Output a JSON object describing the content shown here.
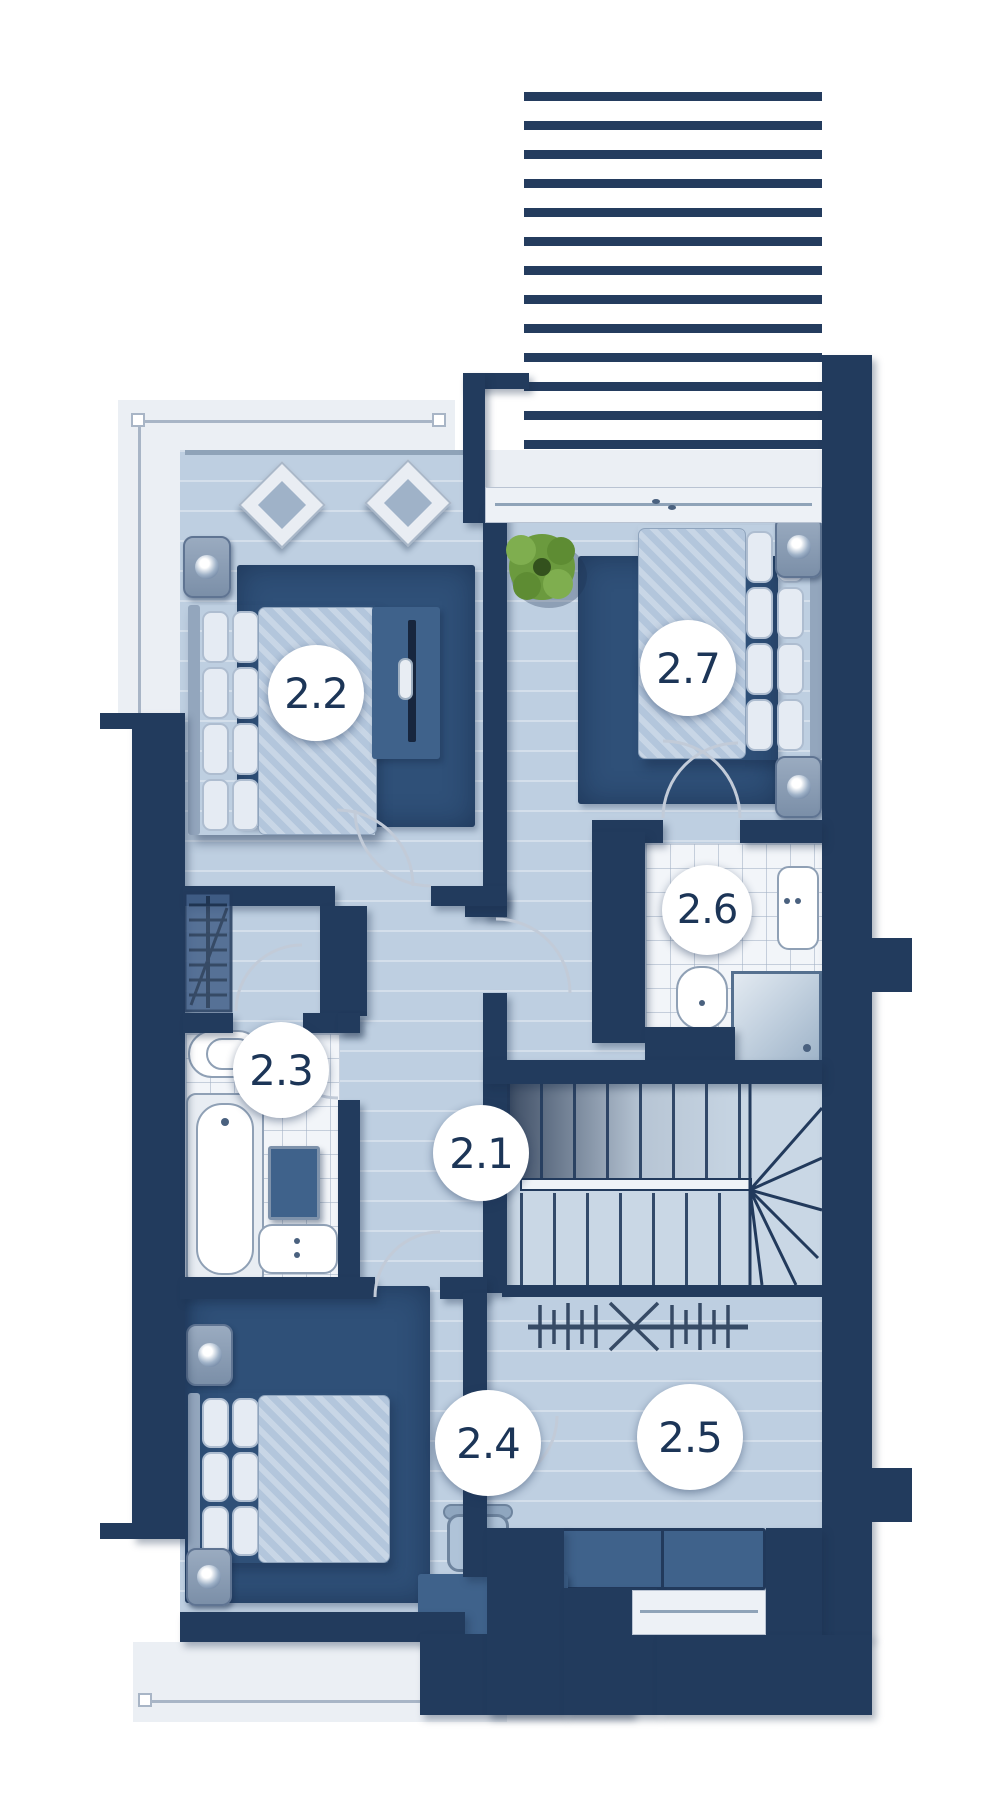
{
  "plan": {
    "rooms": [
      {
        "id": "2.1",
        "label": "2.1",
        "type": "hallway"
      },
      {
        "id": "2.2",
        "label": "2.2",
        "type": "bedroom"
      },
      {
        "id": "2.3",
        "label": "2.3",
        "type": "bathroom"
      },
      {
        "id": "2.4",
        "label": "2.4",
        "type": "bedroom"
      },
      {
        "id": "2.5",
        "label": "2.5",
        "type": "wardrobe"
      },
      {
        "id": "2.6",
        "label": "2.6",
        "type": "bathroom"
      },
      {
        "id": "2.7",
        "label": "2.7",
        "type": "bedroom"
      }
    ],
    "colors": {
      "wall": "#223B5D",
      "floor": "#BECFE1",
      "rug": "#2F5078",
      "furniture": "#3F628B",
      "tile": "#F2F5F9",
      "terrace": "#EBEFF4",
      "plant": "#6E9C3F",
      "label_text": "#1C3557"
    }
  }
}
